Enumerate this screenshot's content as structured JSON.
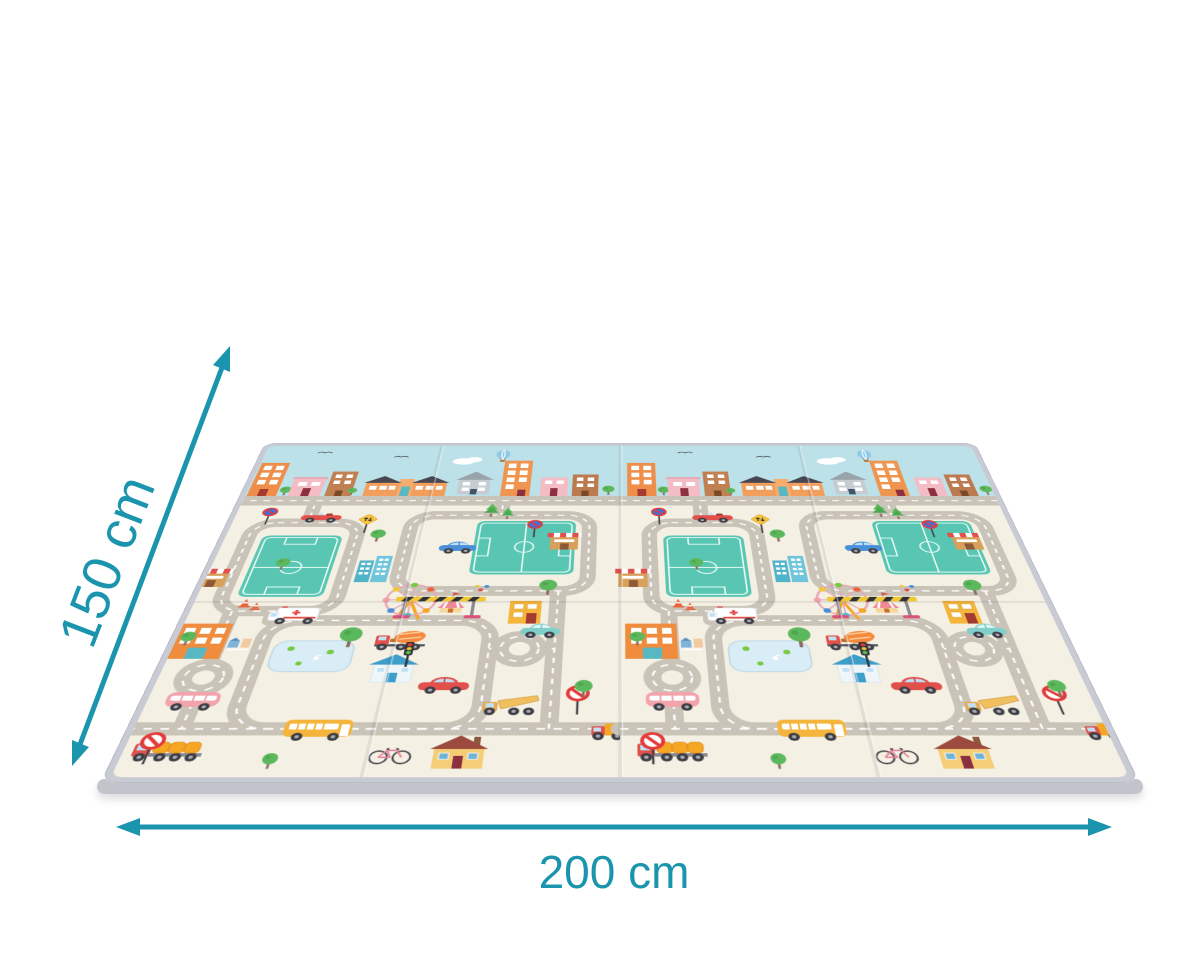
{
  "canvas": {
    "width": 1200,
    "height": 960,
    "background": "#ffffff"
  },
  "dimension_labels": {
    "height": "150 cm",
    "width": "200 cm",
    "unit": "cm",
    "height_value": 150,
    "width_value": 200,
    "color": "#1b95ad"
  },
  "mat": {
    "panels": 4,
    "halves": 2,
    "palette": {
      "sky": "#bce1e8",
      "ground": "#f4f0e3",
      "road": "#cac4b8",
      "road_dash": "#ffffff",
      "field": "#58c6b2",
      "border": "#c9cbd4",
      "edge": "#c3c4cb",
      "crease": "rgba(70,70,85,0.10)"
    },
    "elements": [
      "city-skyline-buildings",
      "birds",
      "cloud",
      "hot-air-balloon",
      "top-street",
      "road-loops",
      "roundabouts",
      "soccer-fields",
      "ferris-wheel",
      "circus-tent",
      "balloons",
      "toll-barrier",
      "traffic-cones",
      "ambulance",
      "concrete-mixer-truck",
      "red-convertible",
      "blue-car",
      "teal-car",
      "red-sedan",
      "pink-minibus",
      "school-bus",
      "hay-truck",
      "dump-truck",
      "delivery-truck",
      "bicycle",
      "traffic-light",
      "no-entry-signs",
      "no-parking-signs",
      "warning-sign",
      "shops-with-awnings",
      "fire-station",
      "apartment-buildings",
      "blue-roof-house",
      "yellow-house",
      "mini-crossing-houses",
      "pond-with-lily-pads",
      "trees"
    ]
  }
}
